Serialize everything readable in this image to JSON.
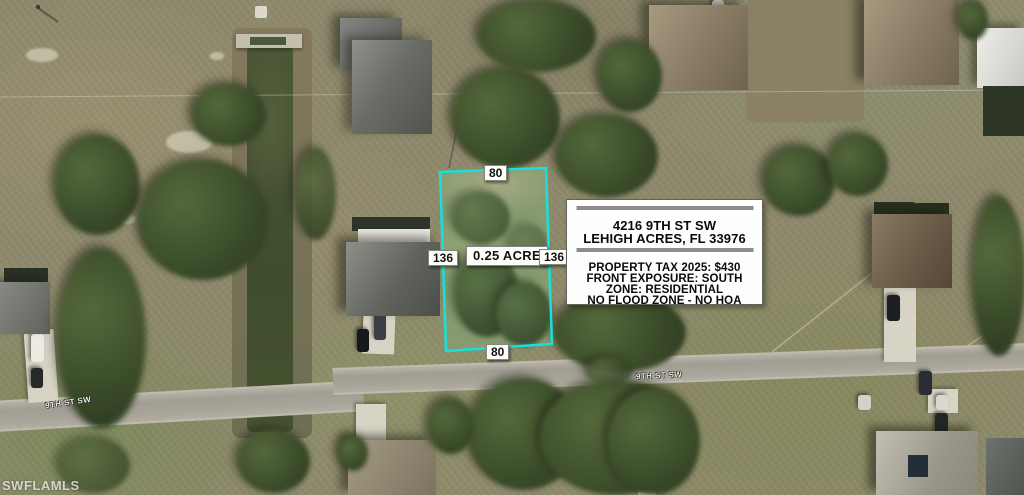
{
  "watermark": "SWFLAMLS",
  "streets": {
    "left_label": "9TH ST SW",
    "road_label": "9TH ST SW"
  },
  "parcel": {
    "area": "0.25 ACRE",
    "front_dim": "80",
    "rear_dim": "80",
    "left_dim": "136",
    "right_dim": "136",
    "outline_color": "#15e2da"
  },
  "info_box": {
    "divider": "========================================",
    "address_line1": "4216 9TH ST SW",
    "address_line2": "LEHIGH ACRES, FL 33976",
    "details": [
      "PROPERTY TAX 2025: $430",
      "FRONT EXPOSURE: SOUTH",
      "ZONE: RESIDENTIAL",
      "NO FLOOD ZONE - NO HOA"
    ]
  }
}
